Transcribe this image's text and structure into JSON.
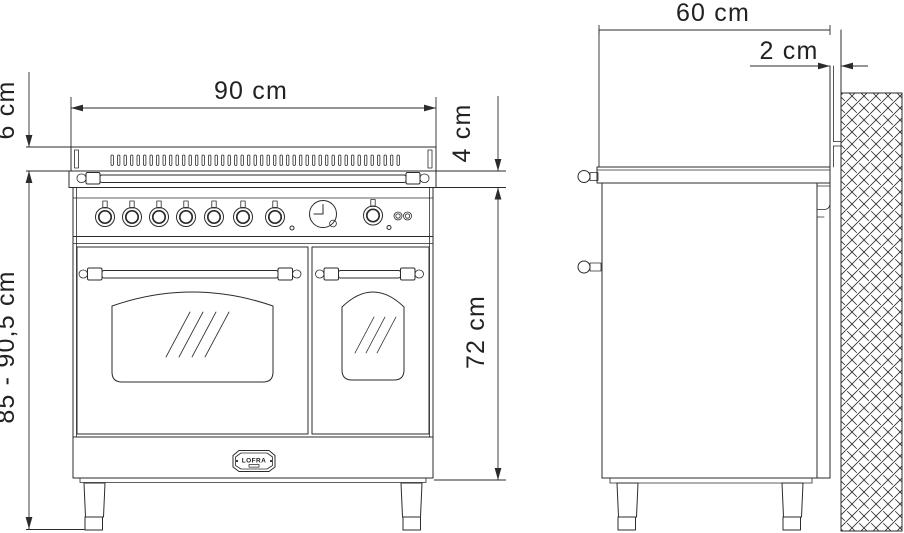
{
  "drawing": {
    "subject": "double-oven range cooker, front and side elevation with installation dimensions"
  },
  "dimensions": {
    "width": {
      "label": "90 cm"
    },
    "backguard_height": {
      "label": "6 cm"
    },
    "rail_band_height": {
      "label": "4 cm"
    },
    "body_height": {
      "label": "72 cm"
    },
    "total_height": {
      "label": "85 - 90,5 cm"
    },
    "depth": {
      "label": "60 cm"
    },
    "wall_clearance": {
      "label": "2 cm"
    }
  },
  "brand_plate": {
    "text": "LOFRA"
  },
  "front_view": {
    "vent_slot_count": 45,
    "burner_knob_count": 7,
    "oven_knob_count": 1,
    "indicator_light_count": 2,
    "glass_reflection_lines_left": 4,
    "glass_reflection_lines_right": 3
  },
  "colors": {
    "line": "#2b2b2b",
    "background": "#ffffff"
  }
}
